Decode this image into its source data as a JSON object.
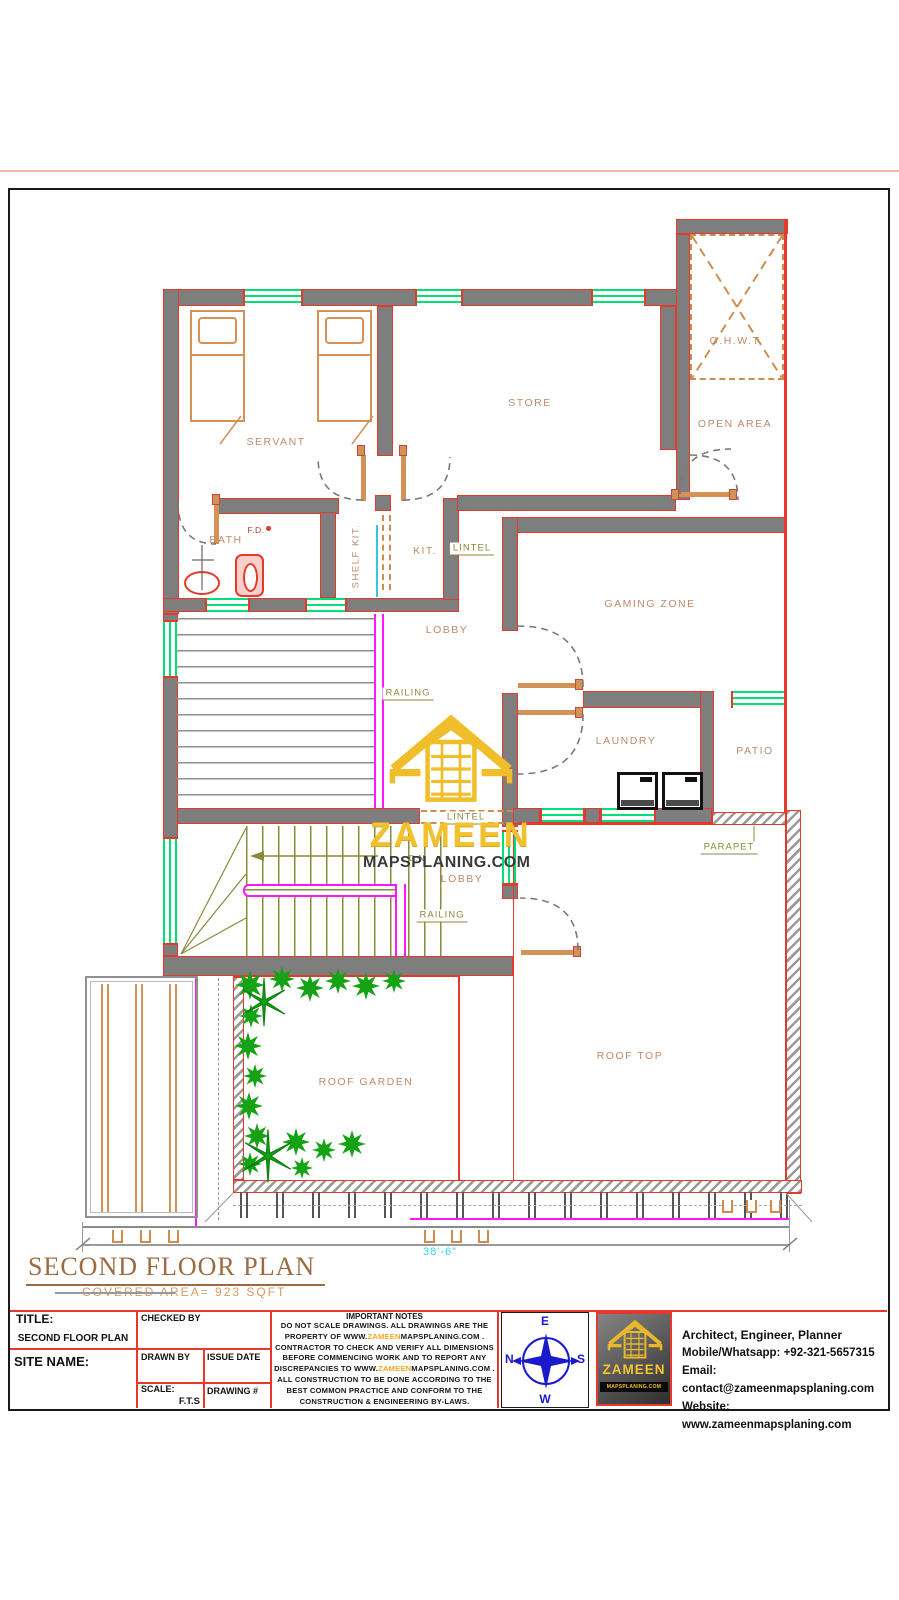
{
  "plan": {
    "room_labels": [
      {
        "text": "SERVANT",
        "x": 276,
        "y": 442
      },
      {
        "text": "STORE",
        "x": 530,
        "y": 403
      },
      {
        "text": "O.H.W.T",
        "x": 735,
        "y": 341
      },
      {
        "text": "OPEN AREA",
        "x": 735,
        "y": 424
      },
      {
        "text": "BATH",
        "x": 226,
        "y": 540
      },
      {
        "text": "KIT.",
        "x": 425,
        "y": 551
      },
      {
        "text": "GAMING ZONE",
        "x": 650,
        "y": 604
      },
      {
        "text": "LOBBY",
        "x": 447,
        "y": 630
      },
      {
        "text": "LAUNDRY",
        "x": 626,
        "y": 741
      },
      {
        "text": "PATIO",
        "x": 755,
        "y": 751
      },
      {
        "text": "LOBBY",
        "x": 462,
        "y": 879
      },
      {
        "text": "ROOF GARDEN",
        "x": 366,
        "y": 1082
      },
      {
        "text": "ROOF TOP",
        "x": 630,
        "y": 1056
      }
    ],
    "vertical_labels": [
      {
        "text": "SHELF KIT.",
        "x": 356,
        "y": 556
      }
    ],
    "small_labels": [
      {
        "text": "F.D.",
        "x": 256,
        "y": 530,
        "color": "#b03a2e"
      },
      {
        "text": "D.N",
        "x": 417,
        "y": 858,
        "color": "#8a8a3c"
      }
    ],
    "callouts": [
      {
        "text": "LINTEL",
        "x": 472,
        "y": 549
      },
      {
        "text": "RAILING",
        "x": 408,
        "y": 694
      },
      {
        "text": "LINTEL",
        "x": 466,
        "y": 818
      },
      {
        "text": "RAILING",
        "x": 442,
        "y": 916
      },
      {
        "text": "PARAPET",
        "x": 729,
        "y": 848
      }
    ],
    "watermark": {
      "brand": "ZAMEEN",
      "domain": "MAPSPLANING.COM"
    },
    "dimension": "38'-6\"",
    "plan_title": "SECOND FLOOR PLAN",
    "covered_area": "COVERED AREA= 923 SQFT"
  },
  "titleblock": {
    "title_label": "TITLE:",
    "title_value": "SECOND FLOOR PLAN",
    "site_name_label": "SITE NAME:",
    "checked_by": "CHECKED BY",
    "drawn_by": "DRAWN BY",
    "issue_date": "ISSUE DATE",
    "scale_label": "SCALE:",
    "scale_value": "F.T.S",
    "drawing_no": "DRAWING #",
    "notes_title": "IMPORTANT NOTES",
    "notes_lines": [
      "DO NOT SCALE DRAWINGS. ALL DRAWINGS ARE THE",
      "PROPERTY OF  WWW.ZAMEENMAPSPLANING.COM .",
      "CONTRACTOR TO CHECK AND VERIFY ALL DIMENSIONS",
      "BEFORE COMMENCING WORK AND TO REPORT ANY",
      "DISCREPANCIES TO WWW.ZAMEENMAPSPLANING.COM .",
      "ALL CONSTRUCTION TO BE DONE ACCORDING TO THE",
      "BEST COMMON PRACTICE AND CONFORM TO THE",
      "CONSTRUCTION & ENGINEERING BY-LAWS."
    ],
    "compass": {
      "top": "E",
      "left": "N",
      "right": "S",
      "bottom": "W"
    },
    "logo": {
      "brand": "ZAMEEN",
      "domain": "MAPSPLANING.COM"
    },
    "contact": {
      "line1": "Architect, Engineer, Planner",
      "line2": "Mobile/Whatsapp: +92-321-5657315",
      "line3": "Email: contact@zameenmapsplaning.com",
      "line4": "Website: www.zameenmapsplaning.com"
    },
    "colors": {
      "accent_red": "#e6392c",
      "window_green": "#00df78",
      "railing_magenta": "#ff18ff",
      "brand_gold": "#f5c330",
      "compass_blue": "#1a1acc",
      "dimension_cyan": "#30dbe3"
    }
  }
}
